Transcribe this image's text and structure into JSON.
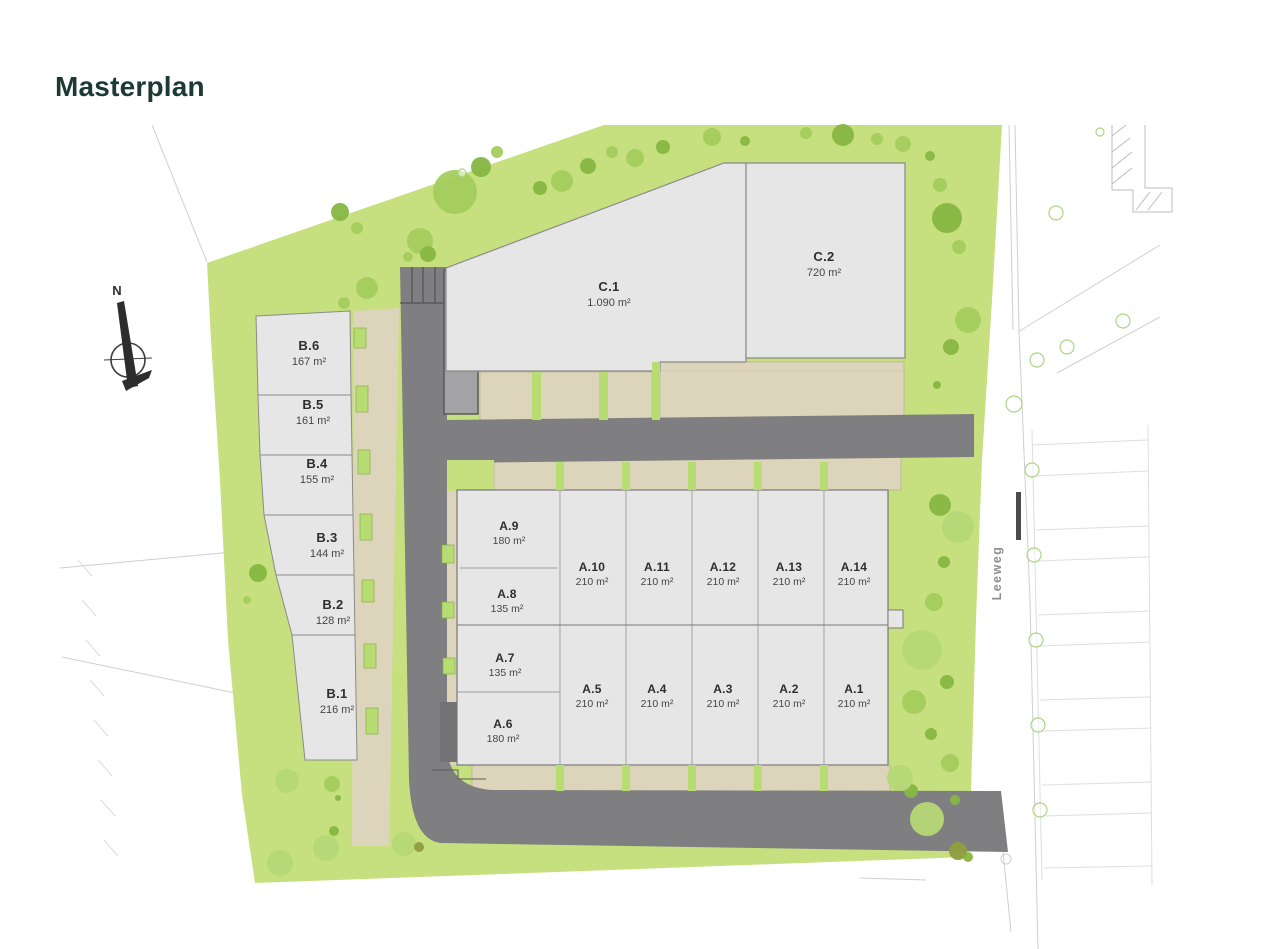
{
  "page": {
    "title": "Masterplan"
  },
  "compass": {
    "north": "N"
  },
  "street": {
    "name": "Leeweg"
  },
  "plots": {
    "b": [
      {
        "id": "B.6",
        "area": "167 m²"
      },
      {
        "id": "B.5",
        "area": "161 m²"
      },
      {
        "id": "B.4",
        "area": "155 m²"
      },
      {
        "id": "B.3",
        "area": "144 m²"
      },
      {
        "id": "B.2",
        "area": "128 m²"
      },
      {
        "id": "B.1",
        "area": "216 m²"
      }
    ],
    "a_col": [
      {
        "id": "A.9",
        "area": "180 m²"
      },
      {
        "id": "A.8",
        "area": "135 m²"
      },
      {
        "id": "A.7",
        "area": "135 m²"
      },
      {
        "id": "A.6",
        "area": "180 m²"
      }
    ],
    "a_top": [
      {
        "id": "A.10",
        "area": "210 m²"
      },
      {
        "id": "A.11",
        "area": "210 m²"
      },
      {
        "id": "A.12",
        "area": "210 m²"
      },
      {
        "id": "A.13",
        "area": "210 m²"
      },
      {
        "id": "A.14",
        "area": "210 m²"
      }
    ],
    "a_bottom": [
      {
        "id": "A.5",
        "area": "210 m²"
      },
      {
        "id": "A.4",
        "area": "210 m²"
      },
      {
        "id": "A.3",
        "area": "210 m²"
      },
      {
        "id": "A.2",
        "area": "210 m²"
      },
      {
        "id": "A.1",
        "area": "210 m²"
      }
    ],
    "c": [
      {
        "id": "C.1",
        "area": "1.090 m²"
      },
      {
        "id": "C.2",
        "area": "720 m²"
      }
    ]
  },
  "colors": {
    "title_text": "#1b3a31",
    "site_green": "#c6e07f",
    "tree_green": "#8fbf4a",
    "road_gray": "#7f7f81",
    "plot_gray": "#e6e6e6",
    "garden_beige": "#dcd5bb",
    "label_text": "#2e2e2e",
    "street_text": "#8e8e8e"
  }
}
